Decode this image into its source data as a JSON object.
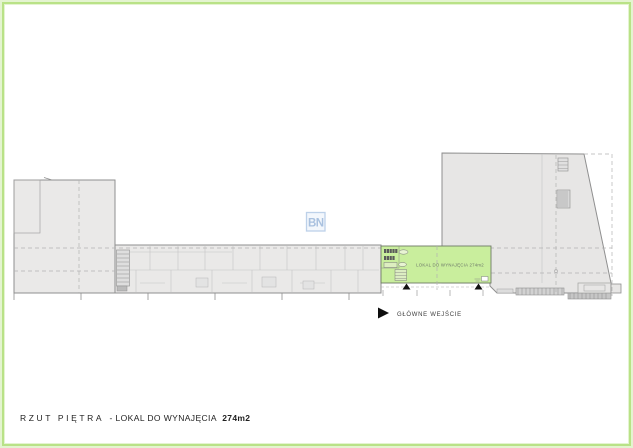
{
  "frame": {
    "border_green": "#b9e287",
    "border_green_light": "#e4f4d0"
  },
  "title": {
    "part1": "RZUT PIĘTRA",
    "part2": "- LOKAL DO WYNAJĘCIA",
    "part3": "274m2"
  },
  "unit": {
    "label": "LOKAL DO WYNAJĘCIA  274m2",
    "fill": "#c9ee9d"
  },
  "entrance": {
    "label": "GŁÓWNE WEJŚCIE"
  },
  "watermark": {
    "label": "BN",
    "bg": "#f3f7fc",
    "border": "#bdd1e9",
    "text_color": "#a9c1df"
  },
  "colors": {
    "building_fill": "#eae9e8",
    "wall": "#8f8f8f",
    "interior": "#c4c4c4",
    "dashed": "#b2b2b2",
    "unit_stroke": "#6f7a66"
  }
}
